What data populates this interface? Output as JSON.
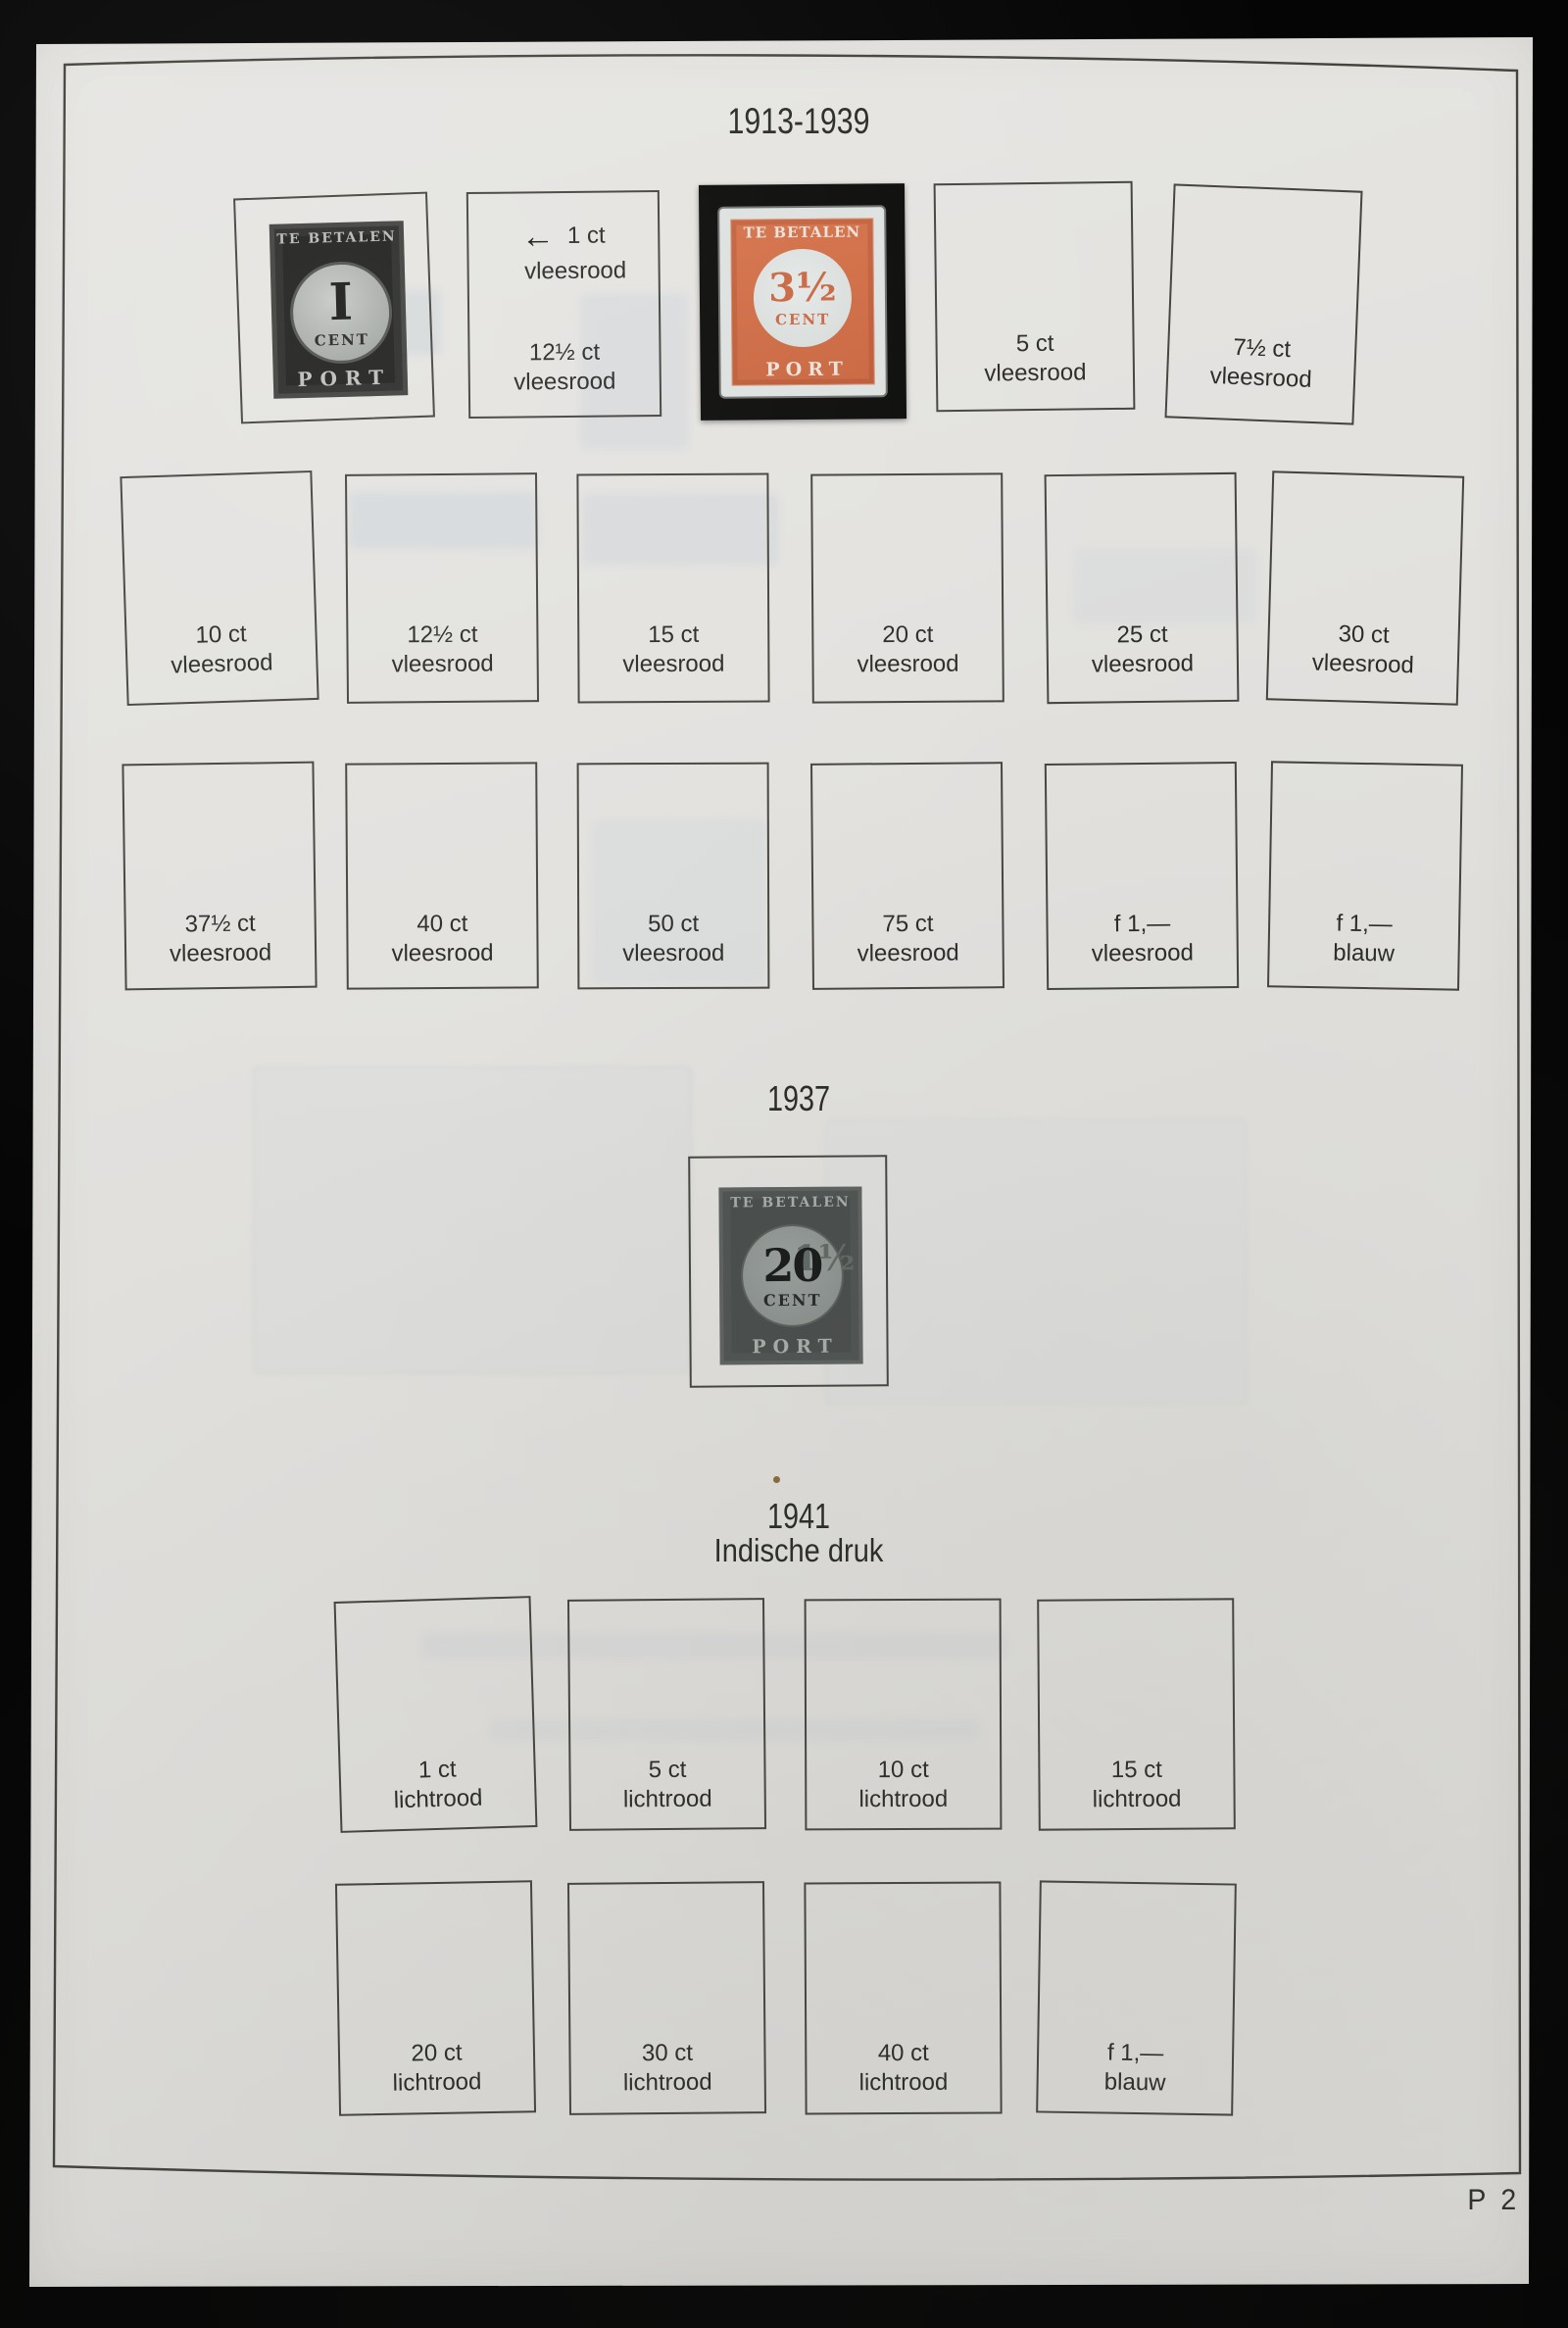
{
  "titles": {
    "series1": "1913-1939",
    "series2": "1937",
    "series3": "1941",
    "series3_sub": "Indische druk"
  },
  "page_number": "P 2",
  "row1": {
    "slot2": {
      "arrow": "←",
      "top_value": "1 ct",
      "top_color": "vleesrood",
      "bottom_value": "12½ ct",
      "bottom_color": "vleesrood"
    },
    "slot4": {
      "value": "5 ct",
      "color": "vleesrood"
    },
    "slot5": {
      "value": "7½ ct",
      "color": "vleesrood"
    }
  },
  "row2": [
    {
      "value": "10 ct",
      "color": "vleesrood"
    },
    {
      "value": "12½ ct",
      "color": "vleesrood"
    },
    {
      "value": "15 ct",
      "color": "vleesrood"
    },
    {
      "value": "20 ct",
      "color": "vleesrood"
    },
    {
      "value": "25 ct",
      "color": "vleesrood"
    },
    {
      "value": "30 ct",
      "color": "vleesrood"
    }
  ],
  "row3": [
    {
      "value": "37½ ct",
      "color": "vleesrood"
    },
    {
      "value": "40 ct",
      "color": "vleesrood"
    },
    {
      "value": "50 ct",
      "color": "vleesrood"
    },
    {
      "value": "75 ct",
      "color": "vleesrood"
    },
    {
      "value": "f 1,—",
      "color": "vleesrood"
    },
    {
      "value": "f 1,—",
      "color": "blauw"
    }
  ],
  "row4": [
    {
      "value": "1 ct",
      "color": "lichtrood"
    },
    {
      "value": "5 ct",
      "color": "lichtrood"
    },
    {
      "value": "10 ct",
      "color": "lichtrood"
    },
    {
      "value": "15 ct",
      "color": "lichtrood"
    }
  ],
  "row5": [
    {
      "value": "20 ct",
      "color": "lichtrood"
    },
    {
      "value": "30 ct",
      "color": "lichtrood"
    },
    {
      "value": "40 ct",
      "color": "lichtrood"
    },
    {
      "value": "f 1,—",
      "color": "blauw"
    }
  ],
  "stamps": {
    "one_cent": {
      "header": "TE BETALEN",
      "value": "I",
      "unit": "CENT",
      "footer": "PORT"
    },
    "three_half_cent": {
      "header": "TE BETALEN",
      "value": "3½",
      "unit": "CENT",
      "footer": "PORT"
    },
    "overprint_1937": {
      "header": "TE BETALEN",
      "overprint": "20",
      "underlying": "1½",
      "unit": "CENT",
      "footer": "PORT"
    }
  },
  "colors": {
    "paper": "#e2e1de",
    "stamp_orange": "#cd6c44",
    "stamp_black": "#20201e",
    "stamp_grey_1937": "#494d4b",
    "ink": "#2b2b28"
  }
}
